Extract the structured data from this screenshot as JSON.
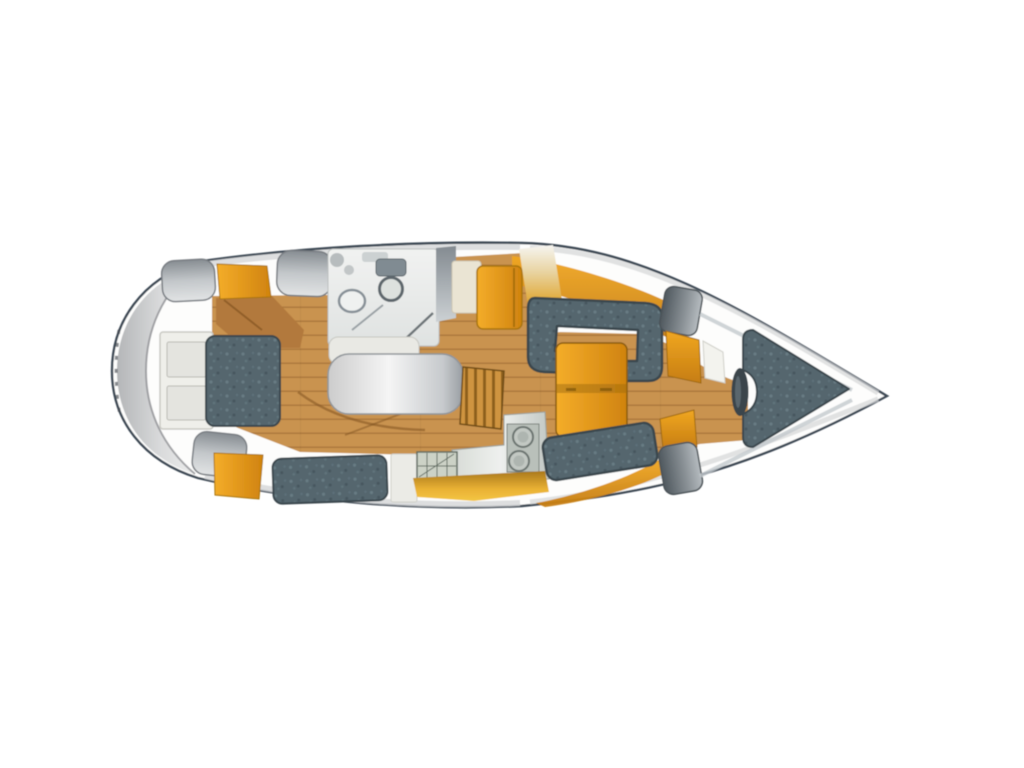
{
  "canvas": {
    "width": 1024,
    "height": 768,
    "background": "#ffffff"
  },
  "diagram": {
    "kind": "sailboat-interior-layout-plan",
    "orientation": "bow-right-stern-left"
  },
  "palette": {
    "outline": "#3d4854",
    "hull": "#fdfdfc",
    "crescent": "#c9cacc",
    "wood": "#c8924d",
    "wood_dark": "#b2793c",
    "orange": "#e9991d",
    "orange_deep": "#c67d12",
    "amber": "#f2c23c",
    "teal": "#54666e",
    "teal_edge": "#3a474e",
    "gray": "#9aa0a5",
    "gray_dark": "#5e666c",
    "surface_white": "#efefea",
    "cream": "#eae4d3",
    "steel": "#c6ccc7",
    "head_white": "#eef0ef"
  },
  "areas": [
    "stern-swim-step",
    "aft-double-berth-cabin",
    "head-bathroom",
    "center-white-table",
    "companionway-steps",
    "galley-twin-sinks-stove",
    "salon-c-settee",
    "salon-orange-table",
    "forward-lockers",
    "v-berth-forward-cabin"
  ]
}
